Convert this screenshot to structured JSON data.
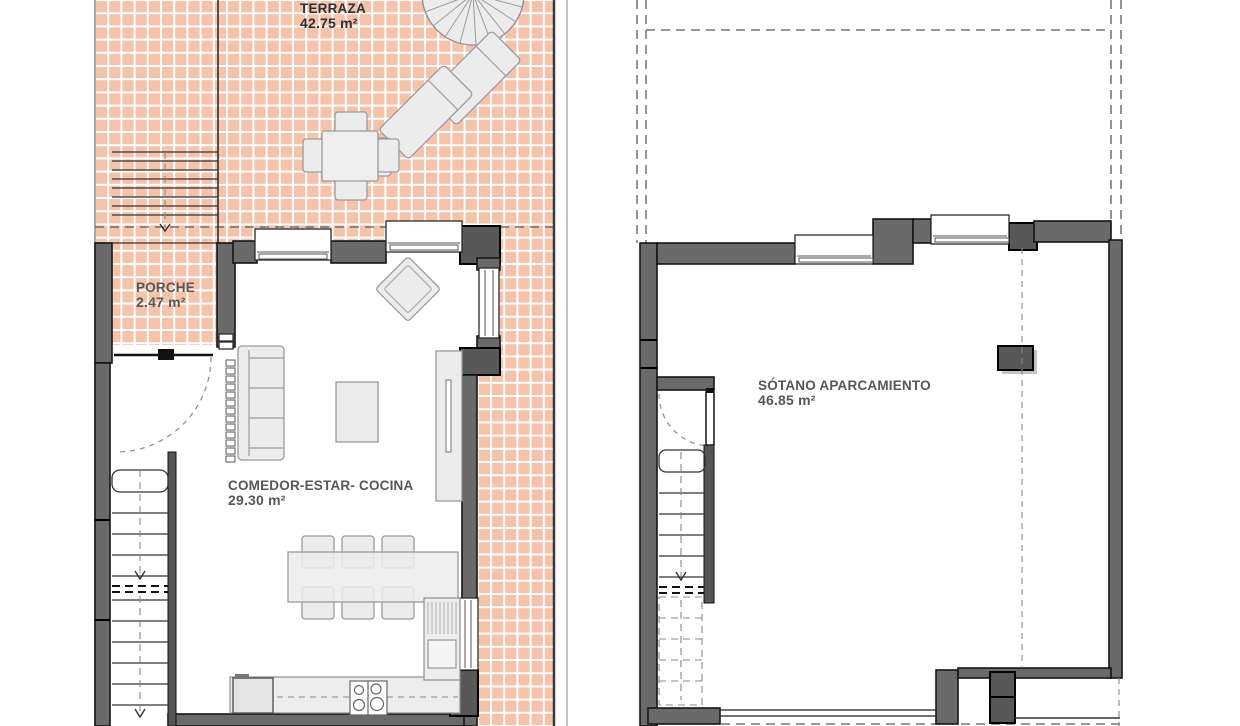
{
  "colors": {
    "tile": "#f5c2aa",
    "grout": "#ffffff",
    "wall": "#6a6a6a",
    "wall_dark": "#585858",
    "furn": "#ececec",
    "label": "#575757",
    "label_dark": "#2e2e2e"
  },
  "plans": {
    "ground_floor": {
      "rooms": [
        {
          "id": "terraza",
          "name": "TERRAZA",
          "area": "42.75 m²"
        },
        {
          "id": "porche",
          "name": "PORCHE",
          "area": "2.47 m²"
        },
        {
          "id": "comedor",
          "name": "COMEDOR-ESTAR- COCINA",
          "area": "29.30 m²"
        }
      ]
    },
    "basement": {
      "rooms": [
        {
          "id": "sotano",
          "name": "SÓTANO APARCAMIENTO",
          "area": "46.85 m²"
        }
      ]
    }
  }
}
